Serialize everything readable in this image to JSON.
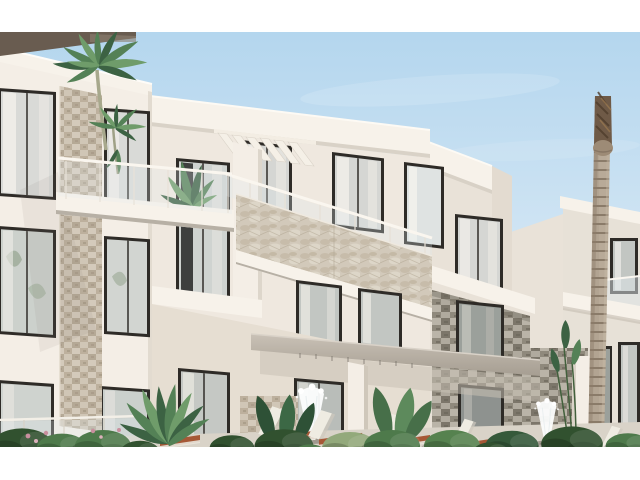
{
  "image": {
    "width": 640,
    "height": 480,
    "letterbox_color": "#ffffff",
    "content_top": 32,
    "content_bottom": 447
  },
  "scene": {
    "kind": "architectural-exterior-render",
    "subject": "modern three-storey apartment complex with balconies, stone cladding, palm trees, pool-deck loungers and fountain jets",
    "elements": [
      "sky",
      "left-wing",
      "main-building",
      "right-wing",
      "glass-balconies",
      "louver-fins",
      "stone-cladding",
      "terrace-canopy",
      "palm-tree-crown",
      "palm-trunk",
      "fountain-jets",
      "sun-loungers",
      "landscaping"
    ]
  },
  "palette": {
    "sky_top": "#b4d6ee",
    "sky_mid": "#cde3f3",
    "sky_low": "#e7edf0",
    "wall_bright": "#f4eee6",
    "wall_sunlit": "#efe8df",
    "wall_shade": "#e3dbd0",
    "wall_rear": "#e9e2d8",
    "wall_rear_far": "#e7e1d7",
    "fascia_light": "#f7f2ea",
    "slab_shadow": "#b7b0a5",
    "eave_dark": "#695c50",
    "frame_dark": "#2e2b27",
    "glass_light": "#d5d6d3",
    "glass_mid": "#c2c6c2",
    "glass_dark": "#9ba09b",
    "curtain_white": "#f3f1ec",
    "canopy_top": "#c9c1b6",
    "canopy_bottom": "#a49c90",
    "trunk_base": "#b2a492",
    "trunk_ring": "#8a7b69",
    "trunk_top": "#6f5a47",
    "leaf_dark": "#3c6243",
    "leaf_mid": "#548156",
    "leaf_light": "#6f9c6a",
    "bush_dark": "#31512f",
    "bush_mid": "#4e7a4b",
    "bush_light": "#93a97b",
    "flower_pink": "#c98f9e",
    "lounger_white": "#efece2",
    "lounger_terracotta": "#a65836",
    "deck": "#d9d3c8",
    "fountain_white": "#fcfdfd",
    "rail_white": "#faf6ef"
  }
}
